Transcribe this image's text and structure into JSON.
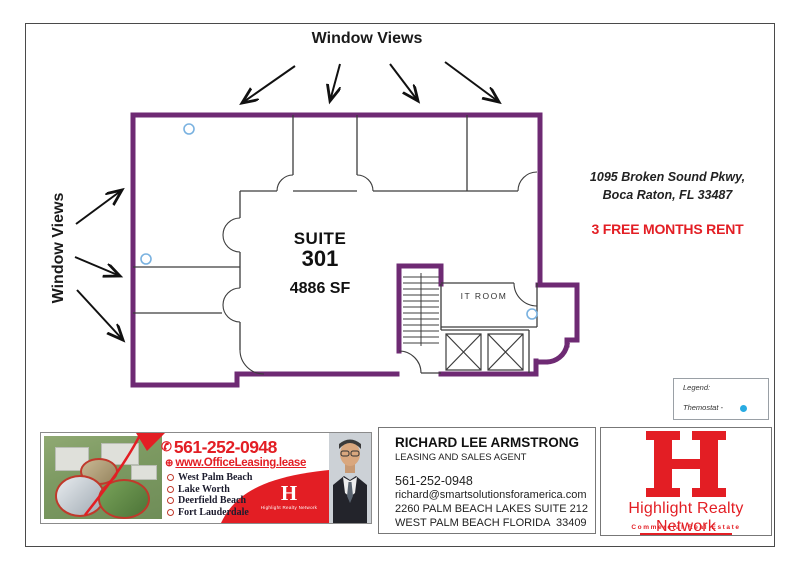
{
  "colors": {
    "wall_purple": "#6e2a73",
    "wall_black": "#3c3c3c",
    "brand_red": "#e31e24",
    "thermostat_fill": "#29abe2",
    "thermostat_ring": "#7ab2e0"
  },
  "annotations": {
    "window_views_top": "Window Views",
    "window_views_left": "Window Views"
  },
  "suite": {
    "label": "SUITE",
    "number": "301",
    "area": "4886 SF",
    "it_room": "IT ROOM"
  },
  "listing": {
    "address_line1": "1095 Broken Sound Pkwy,",
    "address_line2": "Boca Raton, FL 33487",
    "promo": "3 FREE MONTHS RENT"
  },
  "legend": {
    "title": "Legend:",
    "item_label": "Themostat -"
  },
  "banner": {
    "phone": "561-252-0948",
    "website": "www.OfficeLeasing.lease",
    "cities": [
      "West Palm Beach",
      "Lake Worth",
      "Deerfield Beach",
      "Fort Lauderdale"
    ],
    "logo_letter": "H",
    "logo_name": "Highlight Realty Network"
  },
  "agent": {
    "name": "RICHARD LEE ARMSTRONG",
    "role": "LEASING AND SALES AGENT",
    "phone": "561-252-0948",
    "email": "richard@smartsolutionsforamerica.com",
    "address_line1": "2260 PALM BEACH LAKES SUITE 212",
    "address_line2": "WEST PALM BEACH FLORIDA  33409"
  },
  "brand": {
    "letter": "H",
    "name": "Highlight Realty Network",
    "tagline": "Commercial Real Estate"
  }
}
